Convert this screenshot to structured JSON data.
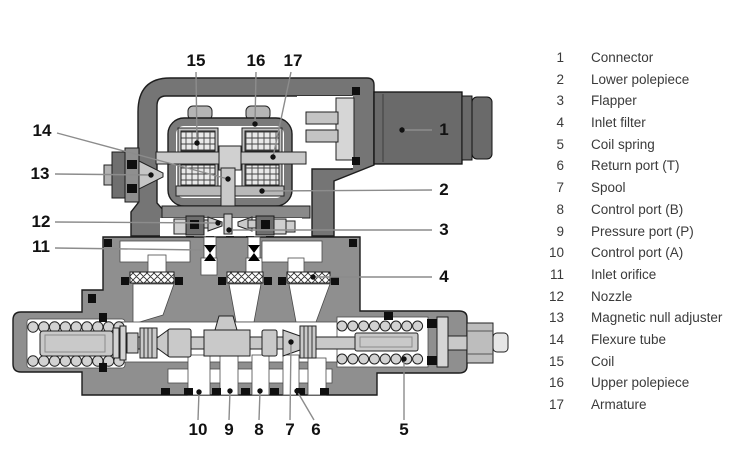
{
  "diagram": {
    "title_hint": "servo-valve-cutaway",
    "callouts": [
      {
        "n": "1",
        "x": 444,
        "y": 130
      },
      {
        "n": "2",
        "x": 444,
        "y": 190
      },
      {
        "n": "3",
        "x": 444,
        "y": 230
      },
      {
        "n": "4",
        "x": 444,
        "y": 277
      },
      {
        "n": "5",
        "x": 404,
        "y": 430
      },
      {
        "n": "6",
        "x": 316,
        "y": 430
      },
      {
        "n": "7",
        "x": 290,
        "y": 430
      },
      {
        "n": "8",
        "x": 259,
        "y": 430
      },
      {
        "n": "9",
        "x": 229,
        "y": 430
      },
      {
        "n": "10",
        "x": 198,
        "y": 430
      },
      {
        "n": "11",
        "x": 41,
        "y": 247
      },
      {
        "n": "12",
        "x": 41,
        "y": 222
      },
      {
        "n": "13",
        "x": 40,
        "y": 174
      },
      {
        "n": "14",
        "x": 42,
        "y": 131
      },
      {
        "n": "15",
        "x": 196,
        "y": 61
      },
      {
        "n": "16",
        "x": 256,
        "y": 61
      },
      {
        "n": "17",
        "x": 293,
        "y": 61
      }
    ],
    "colors": {
      "body_gray": "#8f8f8f",
      "dark_gray": "#757575",
      "connector_gray": "#6a6a6a",
      "light_metal": "#c9c9c9",
      "leader_line": "#8c8c8c",
      "seal_black": "#0f0f0f",
      "text": "#3a3a3a"
    }
  },
  "legend": {
    "items": [
      {
        "n": "1",
        "label": "Connector"
      },
      {
        "n": "2",
        "label": "Lower polepiece"
      },
      {
        "n": "3",
        "label": "Flapper"
      },
      {
        "n": "4",
        "label": "Inlet filter"
      },
      {
        "n": "5",
        "label": "Coil spring"
      },
      {
        "n": "6",
        "label": "Return port (T)"
      },
      {
        "n": "7",
        "label": "Spool"
      },
      {
        "n": "8",
        "label": "Control port (B)"
      },
      {
        "n": "9",
        "label": "Pressure port (P)"
      },
      {
        "n": "10",
        "label": "Control port (A)"
      },
      {
        "n": "11",
        "label": "Inlet orifice"
      },
      {
        "n": "12",
        "label": "Nozzle"
      },
      {
        "n": "13",
        "label": "Magnetic null adjuster"
      },
      {
        "n": "14",
        "label": "Flexure tube"
      },
      {
        "n": "15",
        "label": "Coil"
      },
      {
        "n": "16",
        "label": "Upper polepiece"
      },
      {
        "n": "17",
        "label": "Armature"
      }
    ]
  }
}
